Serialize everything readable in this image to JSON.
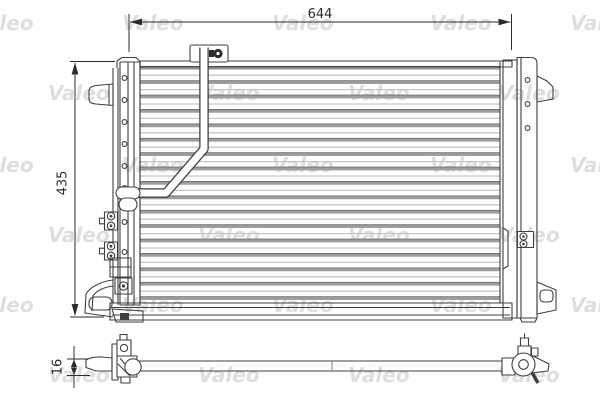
{
  "page": {
    "background": "#ffffff"
  },
  "watermark": {
    "text": "Valeo",
    "color": "#dedede",
    "font_size": 20,
    "rows": [
      {
        "y": 30,
        "xs": [
          -28,
          122,
          272,
          430,
          570
        ]
      },
      {
        "y": 100,
        "xs": [
          48,
          198,
          348,
          498
        ]
      },
      {
        "y": 172,
        "xs": [
          -28,
          122,
          272,
          430,
          570
        ]
      },
      {
        "y": 242,
        "xs": [
          48,
          198,
          348,
          498
        ]
      },
      {
        "y": 312,
        "xs": [
          -28,
          122,
          272,
          430,
          570
        ]
      },
      {
        "y": 382,
        "xs": [
          48,
          198,
          348,
          498
        ]
      }
    ]
  },
  "dimensions": {
    "width_label": "644",
    "height_label": "435",
    "depth_label": "16"
  },
  "drawing": {
    "stroke_color": "#3f3f3f",
    "dim_color": "#2b2b2b",
    "tube_color": "#9e9e9e",
    "tube_edge_color": "#707070",
    "fin_color": "#c6c6c6",
    "core": {
      "x1": 140,
      "x2": 500,
      "y_first_tube": 68,
      "tube_count": 17,
      "tube_spacing": 14.4,
      "tube_width": 3.2,
      "fin_offset": 7.2,
      "fin_count": 16
    },
    "left_header_bolts": {
      "cx": 124.5,
      "r": 2.4,
      "ys": [
        78,
        100,
        122,
        144,
        166,
        188,
        222,
        252
      ]
    },
    "right_header_bolts": {
      "cx": 527.5,
      "r": 2.4,
      "ys": [
        80,
        104,
        128
      ]
    },
    "left_fittings": {
      "ys": [
        221,
        251
      ]
    }
  }
}
